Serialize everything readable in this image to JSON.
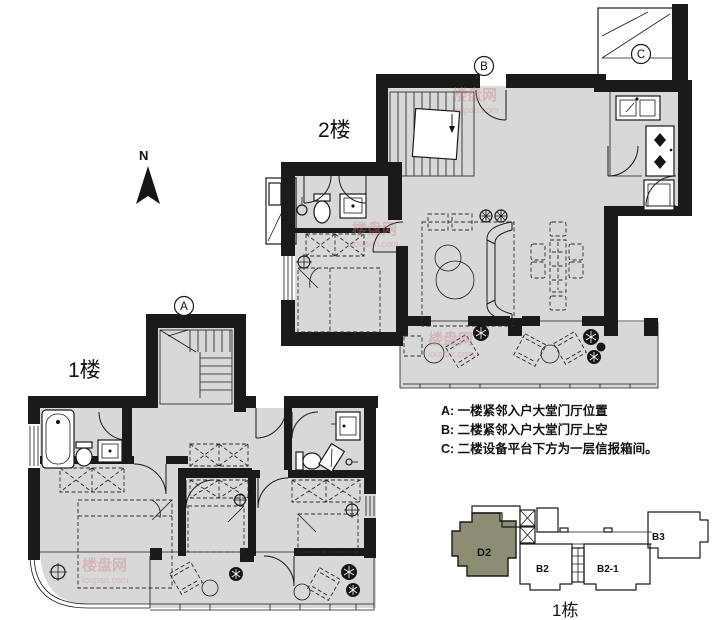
{
  "page": {
    "floor2_label": "2楼",
    "floor1_label": "1楼",
    "north_label": "N"
  },
  "markers": {
    "a": "A",
    "b": "B",
    "c": "C"
  },
  "notes": {
    "line_a": "A: 一楼紧邻入户大堂门厅位置",
    "line_b": "B: 二楼紧邻入户大堂门厅上空",
    "line_c": "C: 二楼设备平台下方为一层信报箱间。"
  },
  "keyplan": {
    "caption": "1栋",
    "highlight_unit": "D2",
    "highlight_color": "#8d8d74",
    "units": {
      "d2": "D2",
      "b2": "B2",
      "b2_1": "B2-1",
      "b3": "B3"
    }
  },
  "watermark": {
    "name": "楼盘网",
    "domain": "loupan.com"
  },
  "colors": {
    "wall": "#1a1a1a",
    "floor_fill": "#d8d8d8",
    "background": "#ffffff"
  }
}
